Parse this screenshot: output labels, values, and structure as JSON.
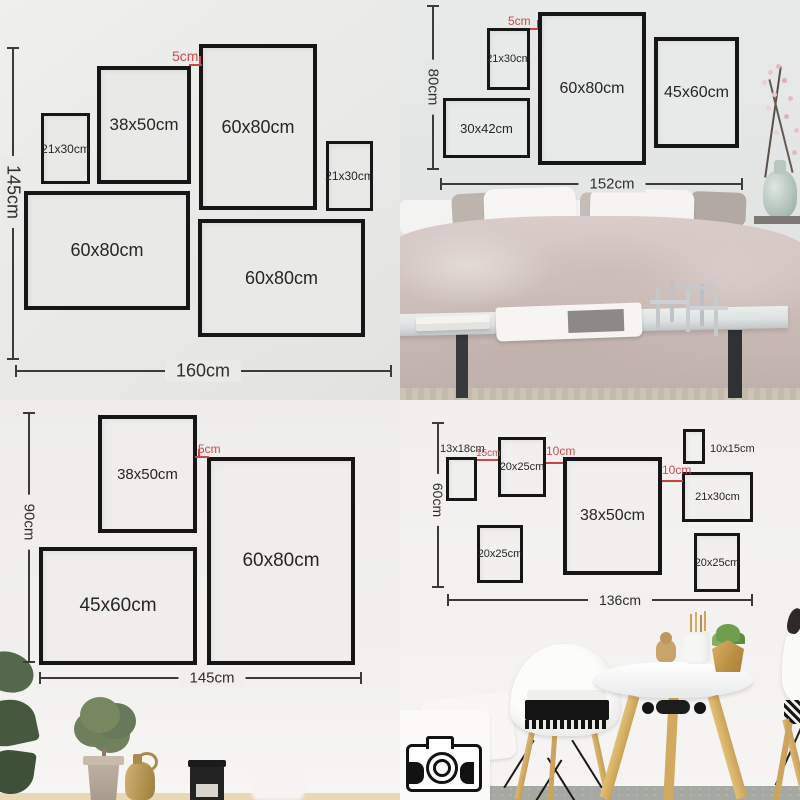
{
  "colors": {
    "accent_red": "#cf4a4e",
    "frame_border": "#161616",
    "dimension_line": "#3b3b3b"
  },
  "panels": {
    "top_left": {
      "height_label": "145cm",
      "width_label": "160cm",
      "gap_label": "5cm",
      "frames": [
        {
          "label": "21x30cm"
        },
        {
          "label": "38x50cm"
        },
        {
          "label": "60x80cm"
        },
        {
          "label": "21x30cm"
        },
        {
          "label": "60x80cm"
        },
        {
          "label": "60x80cm"
        }
      ]
    },
    "top_right": {
      "height_label": "80cm",
      "width_label": "152cm",
      "gap_label": "5cm",
      "frames": [
        {
          "label": "21x30cm"
        },
        {
          "label": "60x80cm"
        },
        {
          "label": "45x60cm"
        },
        {
          "label": "30x42cm"
        }
      ]
    },
    "bottom_left": {
      "height_label": "90cm",
      "width_label": "145cm",
      "gap_label": "5cm",
      "frames": [
        {
          "label": "38x50cm"
        },
        {
          "label": "60x80cm"
        },
        {
          "label": "45x60cm"
        }
      ]
    },
    "bottom_right": {
      "height_label": "60cm",
      "width_label": "136cm",
      "gap_labels": [
        {
          "label": "15cm"
        },
        {
          "label": "10cm"
        },
        {
          "label": "10cm"
        }
      ],
      "frames": [
        {
          "label": "13x18cm"
        },
        {
          "label": "20x25cm"
        },
        {
          "label": "38x50cm"
        },
        {
          "label": "10x15cm"
        },
        {
          "label": "21x30cm"
        },
        {
          "label": "20x25cm"
        },
        {
          "label": "20x25cm"
        }
      ]
    }
  }
}
